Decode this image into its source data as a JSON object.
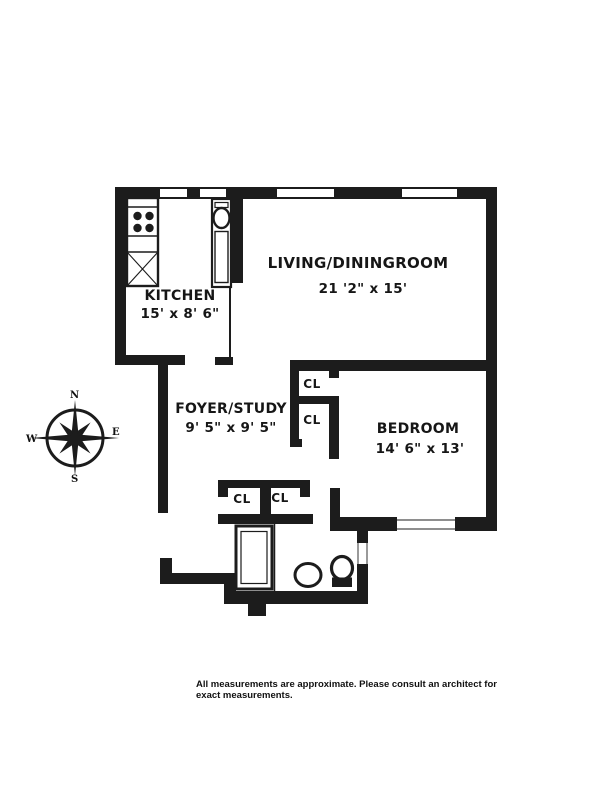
{
  "rooms": {
    "living": {
      "name": "LIVING/DININGROOM",
      "dims": "21 '2\" x 15'"
    },
    "kitchen": {
      "name": "KITCHEN",
      "dims": "15' x 8' 6\""
    },
    "foyer": {
      "name": "FOYER/STUDY",
      "dims": "9' 5\" x 9' 5\""
    },
    "bedroom": {
      "name": "BEDROOM",
      "dims": "14' 6\" x 13'"
    }
  },
  "closet_label": "CL",
  "compass": {
    "north": "N",
    "east": "E",
    "south": "S",
    "west": "W"
  },
  "disclaimer": {
    "line1": "All measurements are approximate. Please consult an architect for",
    "line2": "exact measurements."
  },
  "colors": {
    "wall": "#1c1c1c",
    "background": "#ffffff",
    "text": "#161616"
  }
}
